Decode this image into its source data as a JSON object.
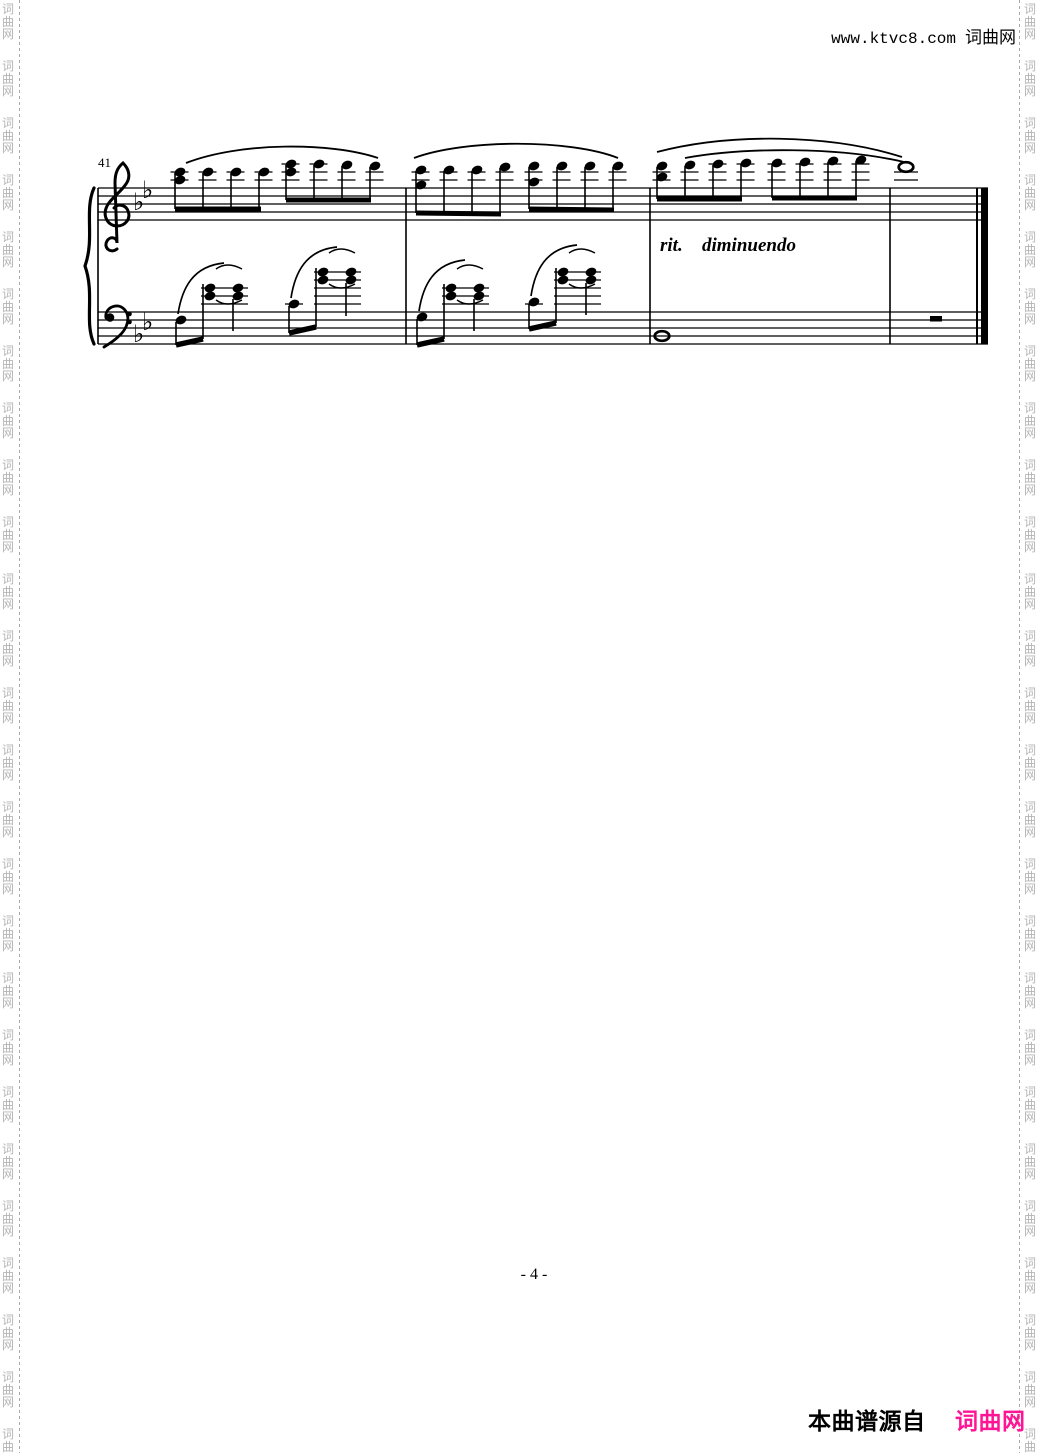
{
  "header": {
    "url_text": "www.ktvc8.com",
    "site_name": "词曲网"
  },
  "watermark": {
    "chars": [
      "词",
      "曲",
      "网"
    ],
    "color": "#b4b4b4",
    "rule_color": "#a8a8a8"
  },
  "footer": {
    "page_number": "- 4 -",
    "credit_label": "本曲谱源自",
    "credit_site": "词曲网",
    "credit_site_color": "#ff1493"
  },
  "score": {
    "measure_number": "41",
    "expression_rit": "rit.",
    "expression_dim": "diminuendo",
    "key_signature": {
      "glyph": "♭",
      "name": "B-flat major, two flats",
      "positions": [
        [
          133,
          210
        ],
        [
          142,
          198
        ],
        [
          133,
          342
        ],
        [
          142,
          330
        ]
      ]
    },
    "staff_x": [
      98,
      988
    ],
    "treble_lines_y": [
      188,
      196,
      204,
      212,
      220
    ],
    "bass_lines_y": [
      312,
      320,
      328,
      336,
      344
    ],
    "barlines_x": [
      98,
      406,
      650,
      890
    ],
    "final_barline": {
      "thin_x": 977,
      "thick_x": 984.5
    },
    "eighth_groups": [
      {
        "beam": [
          175,
          209,
          261,
          209
        ],
        "notes": [
          {
            "x": 180,
            "heads": [
              172,
              180
            ],
            "led": [
              172,
              180
            ]
          },
          {
            "x": 208,
            "heads": [
              172
            ],
            "led": [
              172,
              180
            ]
          },
          {
            "x": 236,
            "heads": [
              172
            ],
            "led": [
              172,
              180
            ]
          },
          {
            "x": 264,
            "heads": [
              172
            ],
            "led": [
              172,
              180
            ]
          }
        ]
      },
      {
        "beam": [
          286,
          200,
          371,
          200
        ],
        "notes": [
          {
            "x": 291,
            "heads": [
              164,
              172
            ],
            "led": [
              164,
              172,
              180
            ]
          },
          {
            "x": 319,
            "heads": [
              164
            ],
            "led": [
              164,
              172,
              180
            ]
          },
          {
            "x": 347,
            "heads": [
              165
            ],
            "led": [
              172,
              180
            ]
          },
          {
            "x": 375,
            "heads": [
              166
            ],
            "led": [
              172,
              180
            ]
          }
        ]
      },
      {
        "beam": [
          416,
          213,
          501,
          214
        ],
        "notes": [
          {
            "x": 421,
            "heads": [
              170,
              185
            ],
            "led": [
              172,
              180
            ]
          },
          {
            "x": 449,
            "heads": [
              170
            ],
            "led": [
              172,
              180
            ]
          },
          {
            "x": 477,
            "heads": [
              170
            ],
            "led": [
              172,
              180
            ]
          },
          {
            "x": 505,
            "heads": [
              167
            ],
            "led": [
              172,
              180
            ]
          }
        ]
      },
      {
        "beam": [
          529,
          209,
          614,
          210
        ],
        "notes": [
          {
            "x": 534,
            "heads": [
              166,
              182
            ],
            "led": [
              172,
              180
            ]
          },
          {
            "x": 562,
            "heads": [
              166
            ],
            "led": [
              172,
              180
            ]
          },
          {
            "x": 590,
            "heads": [
              166
            ],
            "led": [
              172,
              180
            ]
          },
          {
            "x": 618,
            "heads": [
              166
            ],
            "led": [
              172,
              180
            ]
          }
        ]
      },
      {
        "beam": [
          657,
          199,
          742,
          199
        ],
        "notes": [
          {
            "x": 662,
            "heads": [
              166,
              177
            ],
            "led": [
              172,
              180
            ]
          },
          {
            "x": 690,
            "heads": [
              165
            ],
            "led": [
              172,
              180
            ]
          },
          {
            "x": 718,
            "heads": [
              164
            ],
            "led": [
              164,
              172,
              180
            ]
          },
          {
            "x": 746,
            "heads": [
              163
            ],
            "led": [
              164,
              172,
              180
            ]
          }
        ]
      },
      {
        "beam": [
          772,
          198,
          857,
          198
        ],
        "notes": [
          {
            "x": 777,
            "heads": [
              163
            ],
            "led": [
              164,
              172,
              180
            ]
          },
          {
            "x": 805,
            "heads": [
              162
            ],
            "led": [
              164,
              172,
              180
            ]
          },
          {
            "x": 833,
            "heads": [
              161
            ],
            "led": [
              164,
              172,
              180
            ]
          },
          {
            "x": 861,
            "heads": [
              160
            ],
            "led": [
              164,
              172,
              180
            ]
          }
        ]
      }
    ],
    "treble_slurs": [
      [
        186,
        163,
        240,
        142,
        330,
        142,
        378,
        158
      ],
      [
        414,
        158,
        465,
        139,
        570,
        139,
        618,
        158
      ],
      [
        657,
        152,
        730,
        133,
        830,
        134,
        902,
        157
      ],
      [
        685,
        158,
        745,
        147,
        840,
        147,
        904,
        162
      ]
    ],
    "bass_cells": [
      {
        "low": {
          "x": 181,
          "y": 320
        },
        "low_led": null,
        "low_stem": [
          176,
          322,
          176,
          345
        ],
        "beam": [
          176,
          345,
          203,
          339
        ],
        "c1_stem": [
          203,
          339,
          203,
          284
        ],
        "c1": {
          "x": 210,
          "heads": [
            288,
            296
          ]
        },
        "c2": {
          "x": 238,
          "heads": [
            288,
            296
          ]
        },
        "c2_stem": [
          233,
          299,
          233,
          331
        ],
        "led": {
          "ys": [
            288,
            296,
            304
          ],
          "x1": 201,
          "x2": 248
        },
        "slur": [
          178,
          314,
          182,
          288,
          193,
          266,
          224,
          263
        ],
        "tie_top": [
          216,
          269,
          227,
          261,
          242,
          269
        ],
        "tie_bot": [
          216,
          300,
          227,
          308,
          242,
          300
        ]
      },
      {
        "low": {
          "x": 294,
          "y": 304
        },
        "low_led": {
          "y": 304,
          "x1": 285,
          "x2": 303
        },
        "low_stem": [
          289,
          306,
          289,
          333
        ],
        "beam": [
          289,
          333,
          316,
          327
        ],
        "c1_stem": [
          316,
          327,
          316,
          268
        ],
        "c1": {
          "x": 323,
          "heads": [
            272,
            280
          ]
        },
        "c2": {
          "x": 351,
          "heads": [
            272,
            280
          ]
        },
        "c2_stem": [
          346,
          283,
          346,
          316
        ],
        "led": {
          "ys": [
            272,
            280,
            288,
            296,
            304
          ],
          "x1": 314,
          "x2": 361
        },
        "slur": [
          291,
          298,
          295,
          272,
          306,
          250,
          337,
          247
        ],
        "tie_top": [
          329,
          253,
          340,
          245,
          355,
          253
        ],
        "tie_bot": [
          329,
          284,
          340,
          292,
          355,
          284
        ]
      },
      {
        "low": {
          "x": 422,
          "y": 317
        },
        "low_led": null,
        "low_stem": [
          417,
          319,
          417,
          345
        ],
        "beam": [
          417,
          345,
          444,
          339
        ],
        "c1_stem": [
          444,
          339,
          444,
          284
        ],
        "c1": {
          "x": 451,
          "heads": [
            288,
            296
          ]
        },
        "c2": {
          "x": 479,
          "heads": [
            288,
            296
          ]
        },
        "c2_stem": [
          474,
          299,
          474,
          331
        ],
        "led": {
          "ys": [
            288,
            296,
            304
          ],
          "x1": 442,
          "x2": 489
        },
        "slur": [
          419,
          311,
          423,
          285,
          434,
          263,
          465,
          260
        ],
        "tie_top": [
          457,
          269,
          468,
          261,
          483,
          269
        ],
        "tie_bot": [
          457,
          300,
          468,
          308,
          483,
          300
        ]
      },
      {
        "low": {
          "x": 534,
          "y": 302
        },
        "low_led": {
          "y": 304,
          "x1": 525,
          "x2": 543
        },
        "low_stem": [
          529,
          304,
          529,
          329
        ],
        "beam": [
          529,
          329,
          556,
          323
        ],
        "c1_stem": [
          556,
          323,
          556,
          268
        ],
        "c1": {
          "x": 563,
          "heads": [
            272,
            280
          ]
        },
        "c2": {
          "x": 591,
          "heads": [
            272,
            280
          ]
        },
        "c2_stem": [
          586,
          283,
          586,
          315
        ],
        "led": {
          "ys": [
            272,
            280,
            288,
            296,
            304
          ],
          "x1": 554,
          "x2": 601
        },
        "slur": [
          531,
          296,
          535,
          270,
          546,
          248,
          577,
          245
        ],
        "tie_top": [
          569,
          253,
          580,
          245,
          595,
          253
        ],
        "tie_bot": [
          569,
          284,
          580,
          292,
          595,
          284
        ]
      }
    ],
    "whole_notes": [
      {
        "x": 906,
        "y": 167,
        "ledgers": [
          172,
          180
        ]
      },
      {
        "x": 662,
        "y": 336,
        "ledgers": []
      }
    ],
    "half_rest": {
      "x": 930,
      "y": 316,
      "w": 12,
      "h": 5.5
    }
  }
}
